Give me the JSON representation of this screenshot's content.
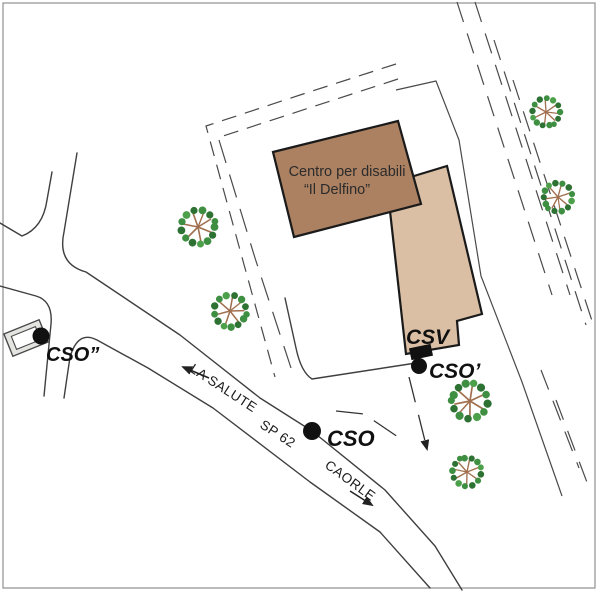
{
  "labels": {
    "building_line1": "Centro per disabili",
    "building_line2": "“Il Delfino”",
    "csv": "CSV",
    "cso": "CSO",
    "cso_prime": "CSO’",
    "cso_double_prime": "CSO”",
    "la_salute": "LA SALUTE",
    "sp62": "SP 62",
    "caorle": "CAORLE"
  },
  "colors": {
    "building_main": "#AC8162",
    "building_annex": "#DABFA5",
    "outline_dark": "#1a1a1a",
    "road_line": "#3f3f3f",
    "boundary_line": "#4a4a4a",
    "tree_green": "#3E8F41",
    "tree_green_dark": "#2E7233",
    "tree_branch": "#A06F4E",
    "marker_black": "#111111",
    "shelter_gray": "#E4E4E1"
  }
}
